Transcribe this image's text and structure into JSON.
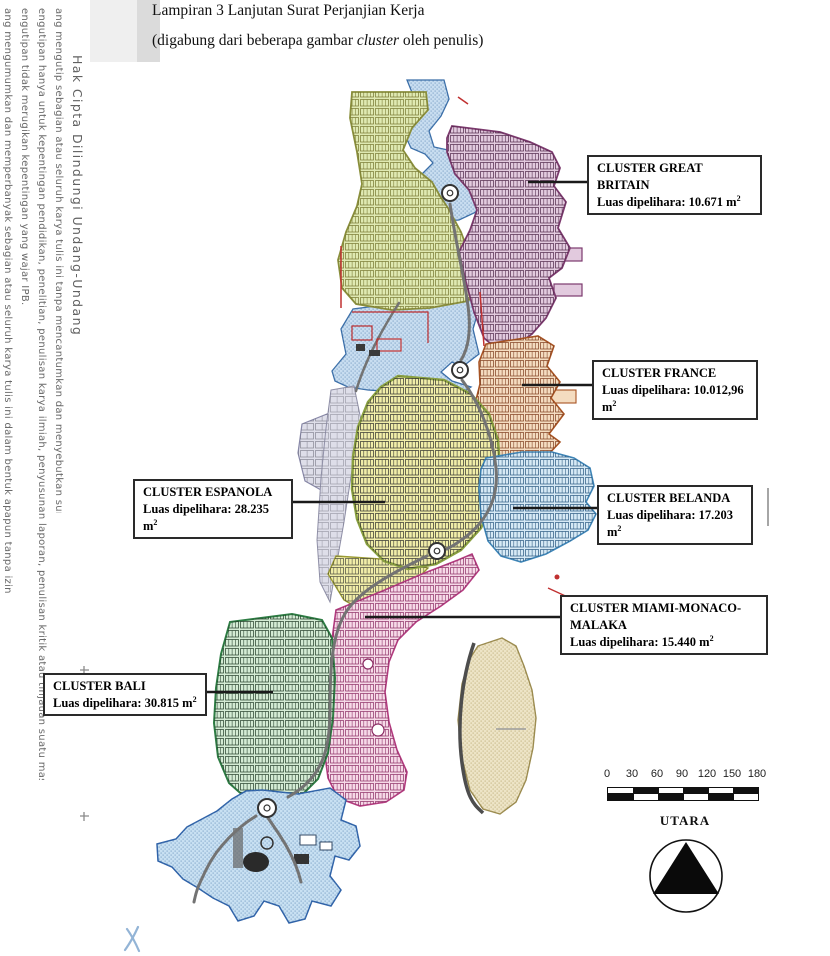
{
  "page": {
    "title": "Lampiran 3 Lanjutan Surat Perjanjian Kerja",
    "subtitle_prefix": "(digabung dari beberapa gambar ",
    "subtitle_italic": "cluster",
    "subtitle_suffix": " oleh penulis)"
  },
  "watermark": {
    "color": "#6a6a6a",
    "lines": [
      "Hak Cipta Dilindungi Undang-Undang",
      "ang mengutip sebagian atau seluruh karya tulis ini tanpa mencantumkan dan menyebutkan sumber:",
      "engutipan hanya untuk kepentingan pendidikan, penelitian, penulisan karya ilmiah, penyusunan laporan, penulisan kritik atau tinjauan suatu masalah.",
      "engutipan tidak merugikan kepentingan yang wajar IPB.",
      "ang mengumumkan dan memperbanyak sebagian atau seluruh karya tulis ini dalam bentuk apapun tanpa izin IPB."
    ]
  },
  "cluster_labels": [
    {
      "title": "CLUSTER GREAT BRITAIN",
      "area_text": "Luas dipelihara: 10.671 m",
      "area_sup": "2"
    },
    {
      "title": "CLUSTER FRANCE",
      "area_text": "Luas dipelihara: 10.012,96 m",
      "area_sup": "2"
    },
    {
      "title": "CLUSTER ESPANOLA",
      "area_text": "Luas dipelihara: 28.235 m",
      "area_sup": "2"
    },
    {
      "title": "CLUSTER BELANDA",
      "area_text": "Luas dipelihara: 17.203 m",
      "area_sup": "2"
    },
    {
      "title": "CLUSTER MIAMI-MONACO-MALAKA",
      "area_text": "Luas dipelihara: 15.440 m",
      "area_sup": "2"
    },
    {
      "title": "CLUSTER BALI",
      "area_text": "Luas dipelihara: 30.815 m",
      "area_sup": "2"
    }
  ],
  "scale_bar": {
    "ticks": [
      "0",
      "30",
      "60",
      "90",
      "120",
      "150",
      "180"
    ]
  },
  "compass": {
    "label": "UTARA"
  },
  "map_colors": {
    "water_fill": "#c8ddf0",
    "green_top_fill": "#dfe9b2",
    "gb_fill": "#e2cade",
    "france_fill": "#f4dcc0",
    "espanola_fill": "#f0eda8",
    "belanda_fill": "#d6e9f5",
    "miami_fill": "#f6d9e7",
    "bali_fill": "#d4ebd4",
    "beige_fill": "#ede4c6",
    "marina_fill": "#c8e0f2",
    "commercial_fill": "#dedee9"
  }
}
